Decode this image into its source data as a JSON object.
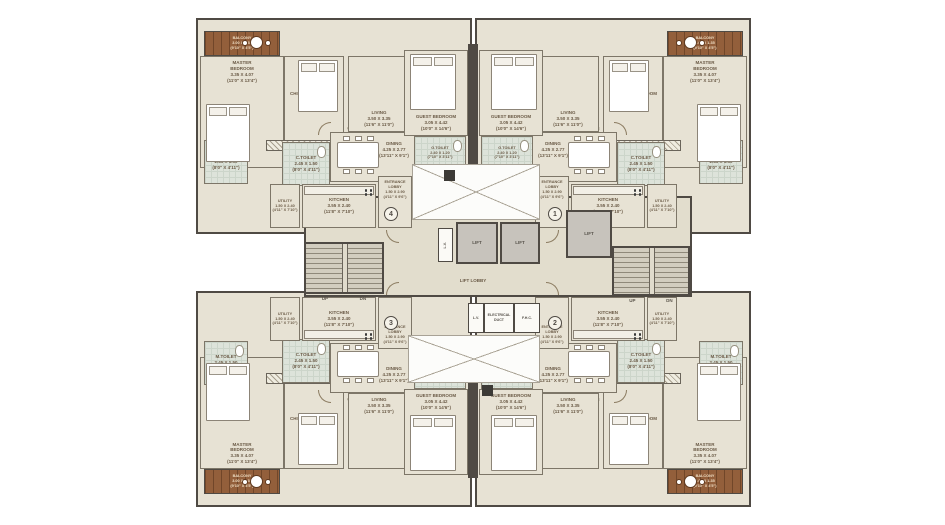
{
  "plan": {
    "type": "residential-tower-typical-floor-plan",
    "colors": {
      "wall": "#4f4a44",
      "floor": "#e7e2d4",
      "core_floor": "#e2ddcd",
      "balcony": "#935f3b",
      "toilet": "#dde3da",
      "lift": "#c7c3bc",
      "text": "#6a5a46"
    },
    "flats": [
      {
        "number": "4",
        "location": "top-left"
      },
      {
        "number": "1",
        "location": "top-right"
      },
      {
        "number": "3",
        "location": "bottom-left"
      },
      {
        "number": "2",
        "location": "bottom-right"
      }
    ],
    "labels": {
      "master_bedroom": "MASTER\nBEDROOM\n3.35 X 4.07\n(11'0\" X 13'4\")",
      "children_bedroom": "CHILDREN BEDROOM\n3.15 X 3.05\n(10'4\" X 10'0\")",
      "guest_bedroom": "GUEST BEDROOM\n3.05 X 4.42\n(10'0\" X 14'6\")",
      "living": "LIVING\n3.50 X 3.35\n(11'6\" X 11'0\")",
      "dining": "DINING\n4.25 X 2.77\n(13'11\" X 9'1\")",
      "kitchen": "KITCHEN\n3.55 X 2.40\n(11'8\" X 7'10\")",
      "utility": "UTILITY\n1.50 X 2.40\n(4'11\" X 7'10\")",
      "entrance_lobby": "ENTRANCE\nLOBBY\n1.50 X 2.90\n(4'11\" X 9'6\")",
      "m_toilet": "M.TOILET\n2.45 X 1.50\n(8'0\" X 4'11\")",
      "c_toilet": "C.TOILET\n2.45 X 1.50\n(8'0\" X 4'11\")",
      "g_toilet": "G.TOILET\n2.40 X 1.20\n(7'10\" X 3'11\")",
      "balcony": "BALCONY\n3.00 X 1.35\n(9'10\" X 4'5\")",
      "wide_passage": "3'0\" (1.12 M)\nWIDE PASSAGE",
      "lift": "LIFT",
      "lift_lobby": "LIFT LOBBY",
      "lv": "L.V.",
      "electrical_duct": "ELECTRICAL\nDUCT",
      "fhc": "F.H.C.",
      "up": "UP",
      "dn": "DN"
    }
  }
}
